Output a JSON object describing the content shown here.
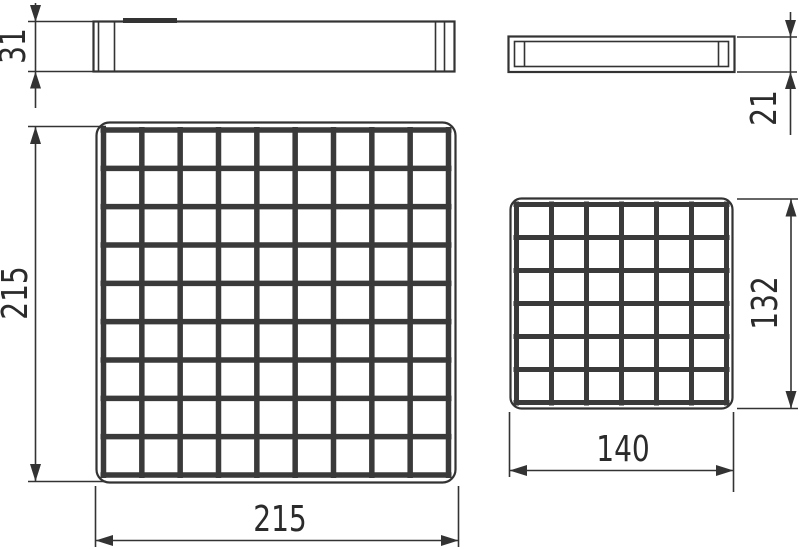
{
  "line_color": "#333333",
  "views": {
    "large_top": {
      "grid_cols": 9,
      "grid_rows": 9
    },
    "small_top": {
      "grid_cols": 6,
      "grid_rows": 6
    }
  },
  "dimensions": {
    "large_side_height": "31",
    "small_side_height": "21",
    "large_top_height": "215",
    "large_top_width": "215",
    "small_top_height": "132",
    "small_top_width": "140"
  }
}
